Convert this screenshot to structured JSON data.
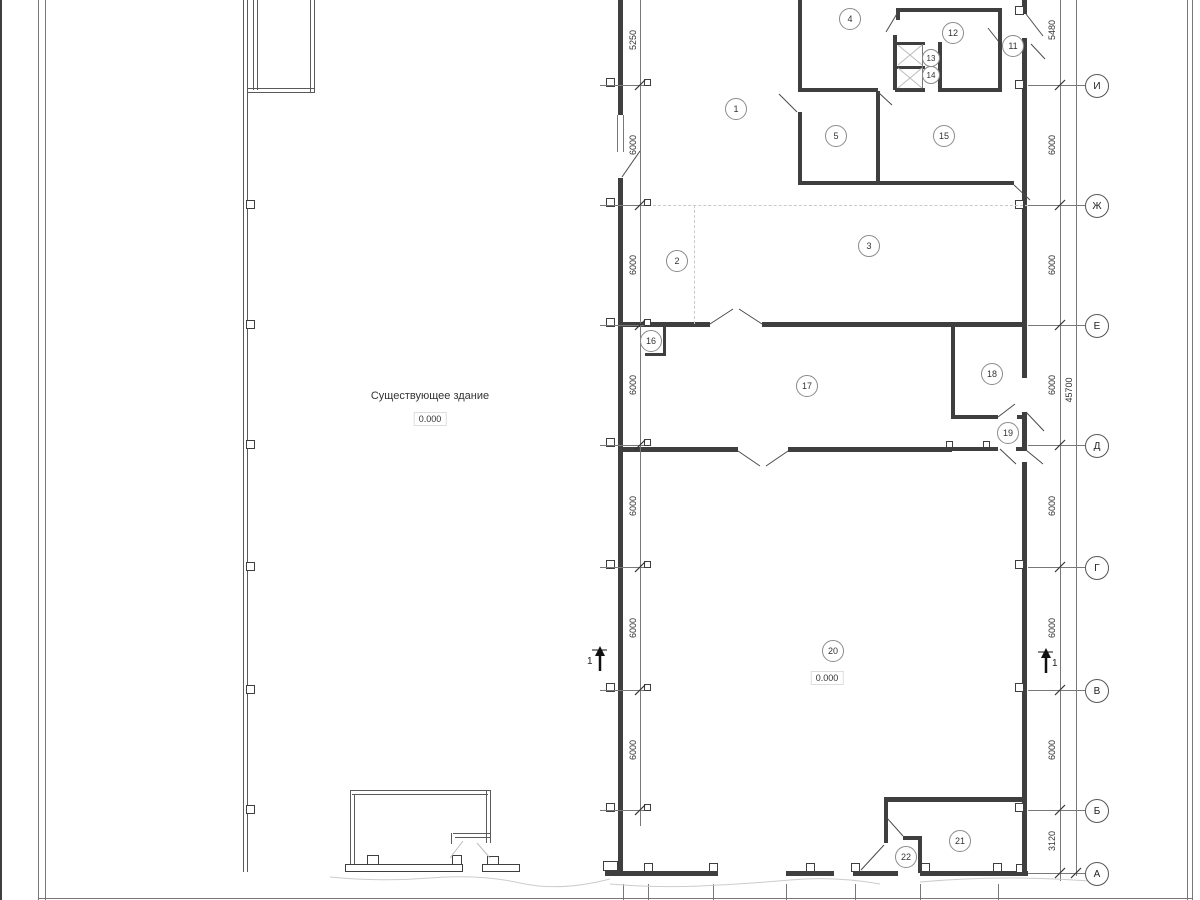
{
  "drawing": {
    "existing_building_label": "Существующее здание",
    "existing_building_level": "0.000",
    "hall_level": "0.000"
  },
  "rooms": [
    {
      "number": "1"
    },
    {
      "number": "2"
    },
    {
      "number": "3"
    },
    {
      "number": "4"
    },
    {
      "number": "5"
    },
    {
      "number": "11"
    },
    {
      "number": "12"
    },
    {
      "number": "13"
    },
    {
      "number": "14"
    },
    {
      "number": "15"
    },
    {
      "number": "16"
    },
    {
      "number": "17"
    },
    {
      "number": "18"
    },
    {
      "number": "19"
    },
    {
      "number": "20"
    },
    {
      "number": "21"
    },
    {
      "number": "22"
    }
  ],
  "grid": {
    "rows": [
      {
        "label": "И"
      },
      {
        "label": "Ж"
      },
      {
        "label": "Е"
      },
      {
        "label": "Д"
      },
      {
        "label": "Г"
      },
      {
        "label": "В"
      },
      {
        "label": "Б"
      },
      {
        "label": "А"
      }
    ]
  },
  "dimensions": {
    "left": [
      {
        "value": "5250"
      },
      {
        "value": "6000"
      },
      {
        "value": "6000"
      },
      {
        "value": "6000"
      },
      {
        "value": "6000"
      },
      {
        "value": "6000"
      },
      {
        "value": "6000"
      }
    ],
    "right": [
      {
        "value": "5480"
      },
      {
        "value": "6000"
      },
      {
        "value": "6000"
      },
      {
        "value": "6000"
      },
      {
        "value": "6000"
      },
      {
        "value": "6000"
      },
      {
        "value": "6000"
      },
      {
        "value": "3120"
      }
    ],
    "right_total": "45700"
  },
  "sections": {
    "left": "1",
    "right": "1"
  }
}
